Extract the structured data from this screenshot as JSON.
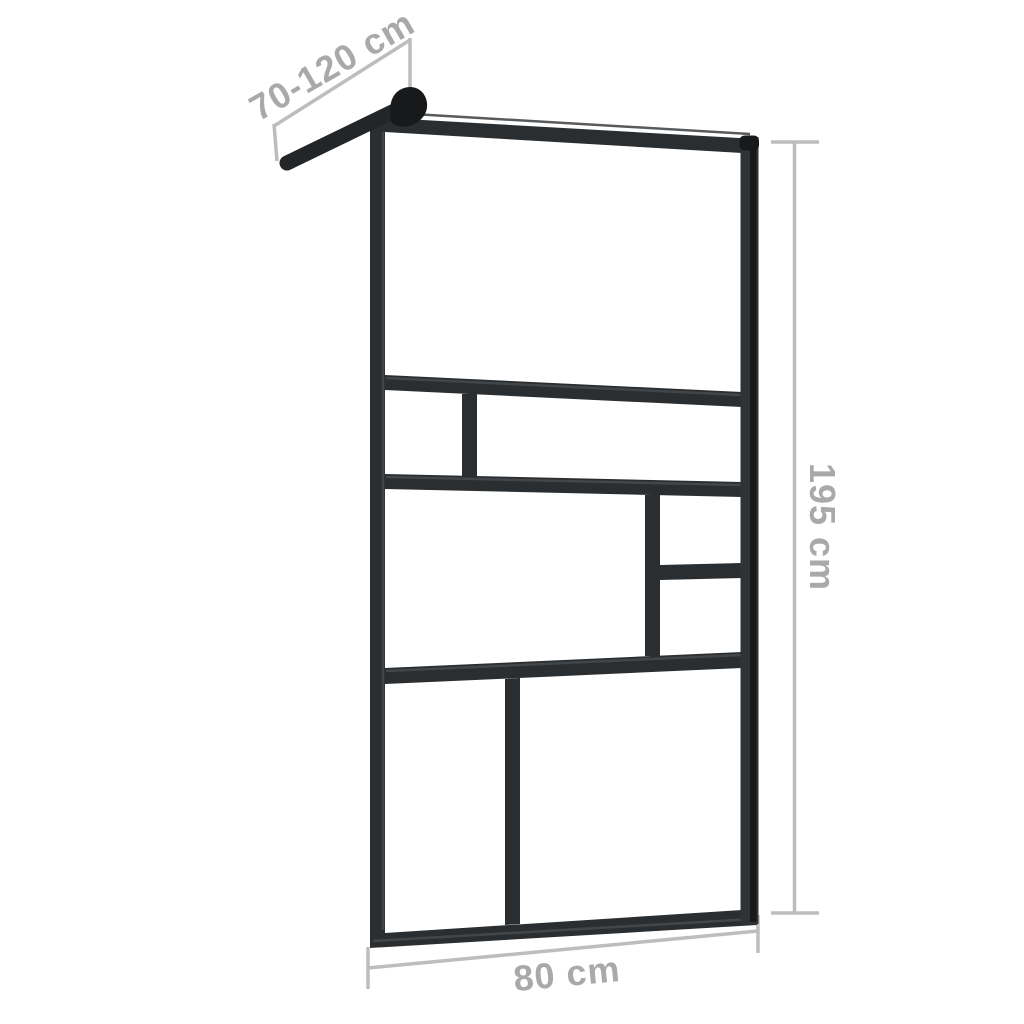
{
  "diagram": {
    "kind": "product-dimension-diagram",
    "dimensions": {
      "support_arm": {
        "label": "70-120 cm"
      },
      "height": {
        "label": "195 cm"
      },
      "width": {
        "label": "80 cm"
      }
    }
  },
  "colors": {
    "background": "#ffffff",
    "frame": "#2b2e30",
    "frame_dark": "#232527",
    "frame_darker": "#17191b",
    "frame_highlight": "#46494c",
    "profile_body": "#303335",
    "dimension_line": "#bdbdbd",
    "dimension_text": "#a9a9a9"
  }
}
